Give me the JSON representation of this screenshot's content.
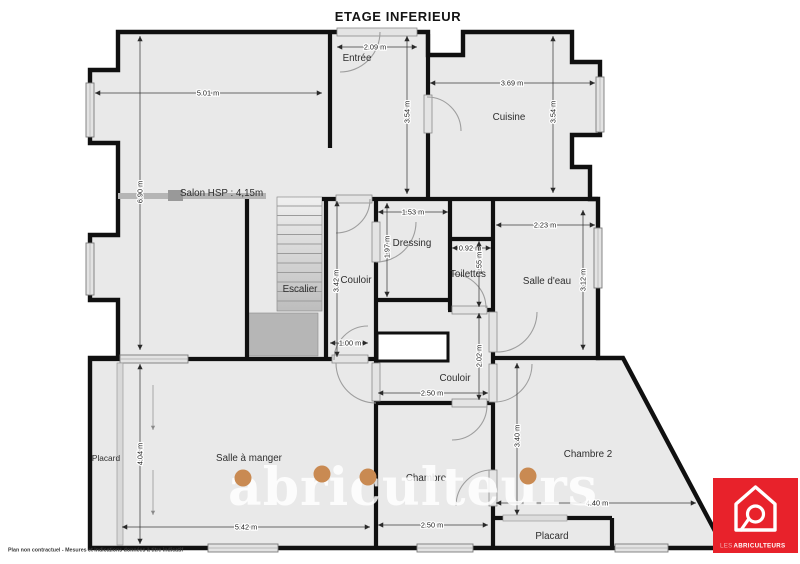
{
  "title": "ETAGE INFERIEUR",
  "rooms": {
    "salon": "Salon HSP : 4,15m",
    "entree": "Entrée",
    "cuisine": "Cuisine",
    "dressing": "Dressing",
    "escalier": "Escalier",
    "couloir_haut": "Couloir",
    "toilettes": "Toilettes",
    "salle_eau": "Salle d'eau",
    "couloir_bas": "Couloir",
    "salle_a_manger": "Salle à manger",
    "placard_gauche": "Placard",
    "chambre": "Chambre",
    "chambre_2": "Chambre 2",
    "placard_chambre2": "Placard"
  },
  "dims": {
    "salon_w": "5.01 m",
    "salon_h": "6.90 m",
    "porte_entree": "2.09 m",
    "entree_h": "3.54 m",
    "cuisine_w": "3.69 m",
    "cuisine_h": "3.54 m",
    "dressing_w": "1.53 m",
    "dressing_h": "1.97 m",
    "couloir_haut_h": "3.42 m",
    "toilettes_w": "0.92 m",
    "toilettes_h": "1.55 m",
    "salle_eau_w": "2.23 m",
    "salle_eau_h": "3.12 m",
    "couloir_bas_w": "2.50 m",
    "couloir_bas_h": "2.02 m",
    "chambre_w": "2.50 m",
    "chambre2_w": "4.40 m",
    "chambre2_h": "3.40 m",
    "sam_w": "5.42 m",
    "sam_h": "4.04 m",
    "porte_couloir": "1.00 m"
  },
  "watermark": {
    "text": "abriculteurs",
    "dot_color": "#c98a52"
  },
  "logo": {
    "brand_prefix": "LES",
    "brand_name": "ABRICULTEURS",
    "bg": "#e8222b"
  },
  "footer": {
    "disclaimer": "Plan non contractuel - Mesures et indications données à titre indicatif"
  },
  "colors": {
    "wall": "#101010",
    "floor": "#e9e9e9",
    "logo_red": "#e8222b",
    "watermark_dot": "#c98a52"
  }
}
